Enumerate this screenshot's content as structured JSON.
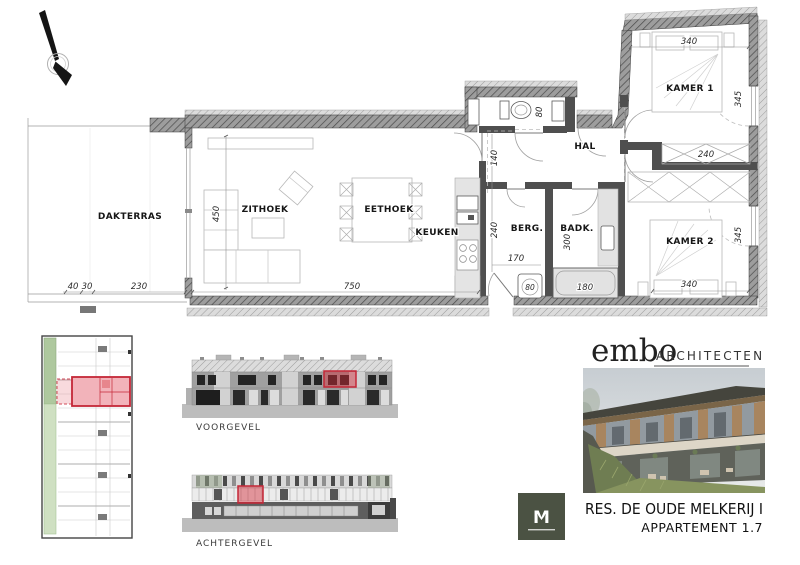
{
  "branding": {
    "firm": "embo",
    "suffix": "ARCHITECTEN"
  },
  "title_block": {
    "project": "RES. DE OUDE MELKERIJ  I",
    "apartment": "APPARTEMENT 1.7"
  },
  "elevations": {
    "front": "VOORGEVEL",
    "rear": "ACHTERGEVEL"
  },
  "plan": {
    "rooms": {
      "dakterras": "DAKTERRAS",
      "zithoek": "ZITHOEK",
      "eethoek": "EETHOEK",
      "keuken": "KEUKEN",
      "hal": "HAL",
      "berg": "BERG.",
      "badk": "BADK.",
      "kamer1": "KAMER 1",
      "kamer2": "KAMER 2"
    },
    "dims": {
      "terras_a": "40",
      "terras_b": "30",
      "terras_c": "230",
      "living_w": "750",
      "living_d": "450",
      "hal_w": "140",
      "wc_w": "80",
      "berg_d": "240",
      "berg_w": "170",
      "badk_d": "300",
      "entry_door": "80",
      "bath_w": "180",
      "k1_w": "340",
      "k1_d": "345",
      "dressing_w": "240",
      "k2_d": "345",
      "k2_w": "340"
    }
  },
  "colors": {
    "highlight": "#c42737",
    "logo_green": "#4b5243"
  }
}
